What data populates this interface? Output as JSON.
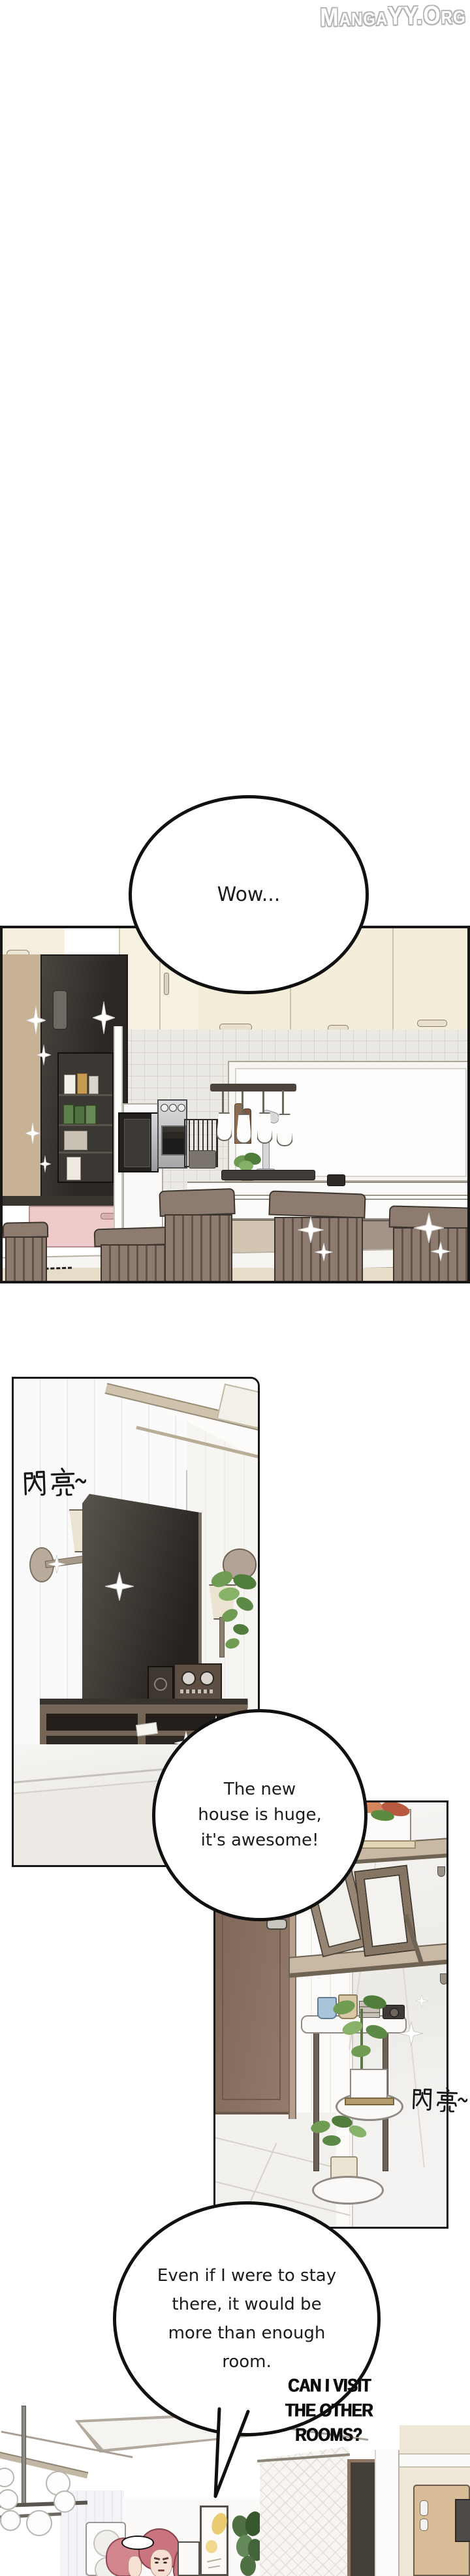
{
  "logo": {
    "text": "MangaYY.Org"
  },
  "speech": {
    "wow": "Wow...",
    "huge": [
      "The new",
      "house is huge,",
      "it's awesome!"
    ],
    "stay": [
      "Even if I were to stay",
      "there, it would be",
      "more than enough",
      "room."
    ],
    "shout": [
      "CAN I VISIT THE",
      "OTHER ROOMS?"
    ]
  },
  "sfx": {
    "sparkle_left": "閃亮~",
    "sparkle_right": "閃亮~"
  },
  "colors": {
    "panel_border": "#161616",
    "cabinet_cream": "#f4edda",
    "pink_drawer": "#eecaca",
    "chair_taupe": "#8d7b6f",
    "fridge_dark": "#37332e",
    "door_brown": "#8d7465",
    "shelf_tan": "#c9b8a4",
    "plant_green": "#6f9b53",
    "hair_pink": "#d4868e",
    "accent_yellow_poster": "#e9cc72"
  }
}
